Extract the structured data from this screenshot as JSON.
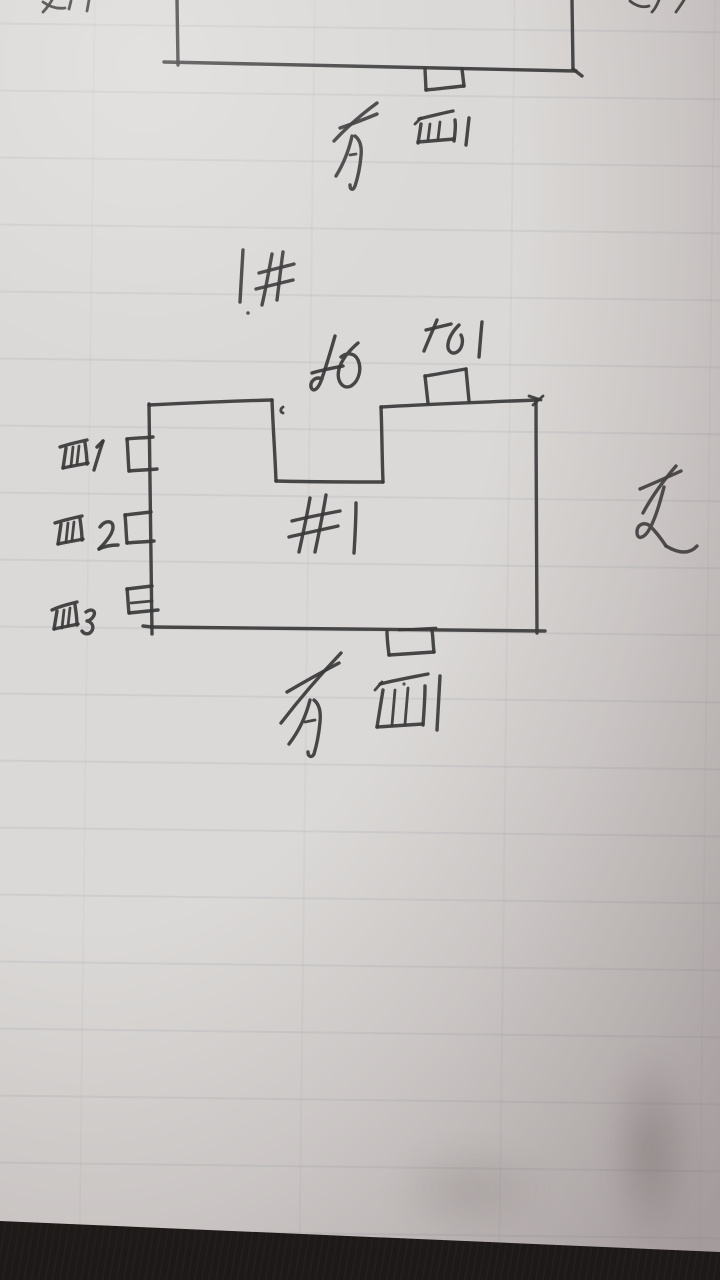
{
  "photo": {
    "description": "Hand-drawn building plan sketches in pen on ruled notebook paper, photographed lying on a dark desk",
    "ink_color": "#3a393b",
    "paper_color": "#dbd9d7",
    "desk_color": "#221e1c"
  },
  "top_sketch": {
    "shape": "large rectangle cut off by the top edge of the photo, small bump on its bottom wall",
    "south_label": "南面1"
  },
  "middle_note": "1井",
  "main_sketch": {
    "building_label": "#1",
    "north_label": "北",
    "north_bump_label": "北1",
    "east_label": "东",
    "south_label": "南面1",
    "west_bump_labels": [
      "西1",
      "西2",
      "西3"
    ],
    "shape": "rectangle with a notch cut into the top wall, one bump on north wall, one bump on south wall, three bumps on west wall"
  },
  "edge_marks": {
    "top_left": "partial pen strokes cut off at top edge",
    "top_right": "partial pen strokes cut off at top edge"
  }
}
